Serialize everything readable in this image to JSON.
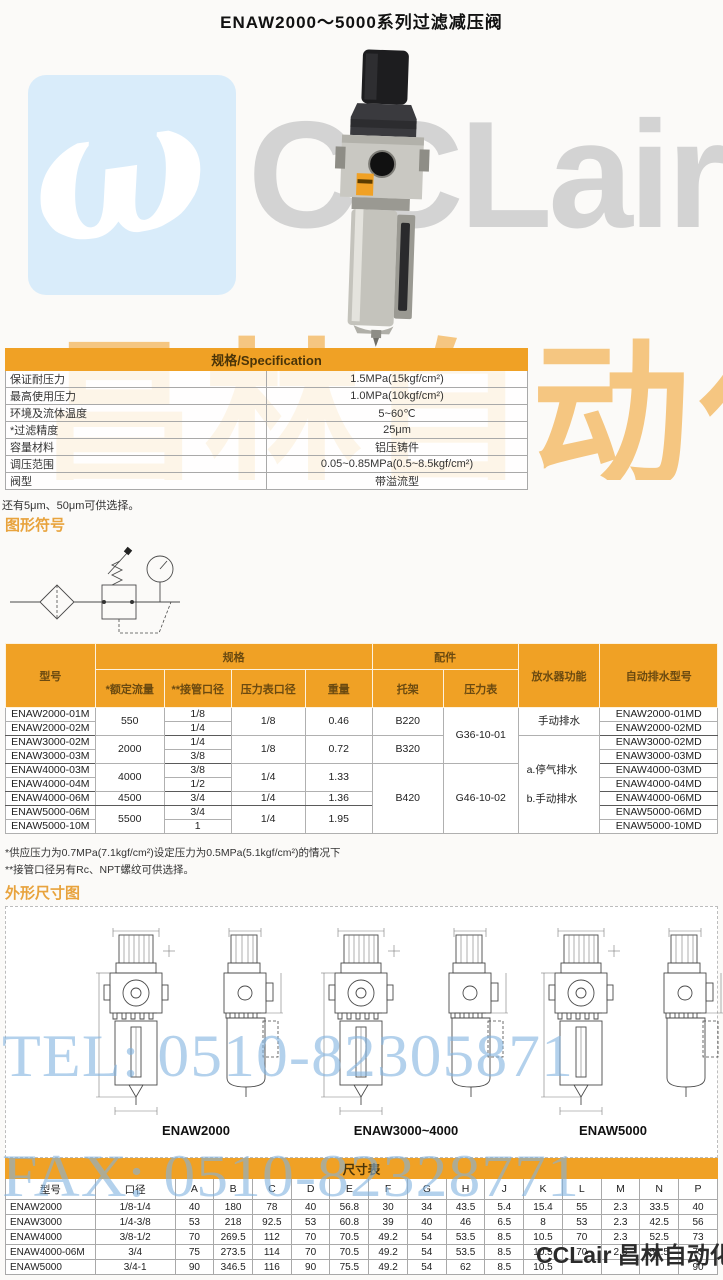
{
  "title": "ENAW2000～5000系列过滤减压阀",
  "watermark": {
    "logo_glyph": "ω",
    "brand": "CCLair",
    "brand_cn": "昌林自动化",
    "tel": "TEL: 0510-82305871",
    "fax": "FAX: 0510-82328771",
    "bottom_brand": "CCLair 昌林自动化",
    "accent_orange": "#f0a125",
    "accent_blue": "#d9ecfa"
  },
  "spec": {
    "header": "规格/Specification",
    "rows": [
      {
        "label": "保证耐压力",
        "value": "1.5MPa(15kgf/cm²)"
      },
      {
        "label": "最高使用压力",
        "value": "1.0MPa(10kgf/cm²)"
      },
      {
        "label": "环境及流体温度",
        "value": "5~60℃"
      },
      {
        "label": "*过滤精度",
        "value": "25μm"
      },
      {
        "label": "容量材料",
        "value": "铝压铸件"
      },
      {
        "label": "调压范围",
        "value": "0.05~0.85MPa(0.5~8.5kgf/cm²)"
      },
      {
        "label": "阀型",
        "value": "带溢流型"
      }
    ],
    "note": "还有5μm、50μm可供选择。"
  },
  "symbol": {
    "title": "图形符号"
  },
  "model_table": {
    "col_model": "型号",
    "group_spec": "规格",
    "group_acc": "配件",
    "col_flow": "*额定流量",
    "col_port": "**接管口径",
    "col_gauge_port": "压力表口径",
    "col_weight": "重量",
    "col_bracket": "托架",
    "col_gauge": "压力表",
    "col_drain": "放水器功能",
    "col_auto": "自动排水型号",
    "models": [
      "ENAW2000-01M",
      "ENAW2000-02M",
      "ENAW3000-02M",
      "ENAW3000-03M",
      "ENAW4000-03M",
      "ENAW4000-04M",
      "ENAW4000-06M",
      "ENAW5000-06M",
      "ENAW5000-10M"
    ],
    "ports": [
      "1/8",
      "1/4",
      "1/4",
      "3/8",
      "3/8",
      "1/2",
      "3/4",
      "3/4",
      "1"
    ],
    "flows": [
      "550",
      "2000",
      "4000",
      "4500",
      "5500"
    ],
    "gauge_ports": [
      "1/8",
      "1/8",
      "1/4",
      "1/4",
      "1/4"
    ],
    "weights": [
      "0.46",
      "0.72",
      "1.33",
      "1.36",
      "1.95"
    ],
    "brackets": [
      "B220",
      "B320",
      "B420"
    ],
    "gauges": [
      "G36-10-01",
      "G46-10-02"
    ],
    "drain_manual": "手动排水",
    "drain_a": "a.停气排水",
    "drain_b": "b.手动排水",
    "autos": [
      "ENAW2000-01MD",
      "ENAW2000-02MD",
      "ENAW3000-02MD",
      "ENAW3000-03MD",
      "ENAW4000-03MD",
      "ENAW4000-04MD",
      "ENAW4000-06MD",
      "ENAW5000-06MD",
      "ENAW5000-10MD"
    ],
    "note1": "*供应压力为0.7MPa(7.1kgf/cm²)设定压力为0.5MPa(5.1kgf/cm²)的情况下",
    "note2": "**接管口径另有Rc、NPT螺纹可供选择。"
  },
  "dimensions": {
    "title": "外形尺寸图",
    "labels": [
      "ENAW2000",
      "ENAW3000~4000",
      "ENAW5000"
    ]
  },
  "size_table": {
    "title": "尺寸表",
    "headers": [
      "型号",
      "口径",
      "A",
      "B",
      "C",
      "D",
      "E",
      "F",
      "G",
      "H",
      "J",
      "K",
      "L",
      "M",
      "N",
      "P"
    ],
    "rows": [
      [
        "ENAW2000",
        "1/8-1/4",
        "40",
        "180",
        "78",
        "40",
        "56.8",
        "30",
        "34",
        "43.5",
        "5.4",
        "15.4",
        "55",
        "2.3",
        "33.5",
        "40"
      ],
      [
        "ENAW3000",
        "1/4-3/8",
        "53",
        "218",
        "92.5",
        "53",
        "60.8",
        "39",
        "40",
        "46",
        "6.5",
        "8",
        "53",
        "2.3",
        "42.5",
        "56"
      ],
      [
        "ENAW4000",
        "3/8-1/2",
        "70",
        "269.5",
        "112",
        "70",
        "70.5",
        "49.2",
        "54",
        "53.5",
        "8.5",
        "10.5",
        "70",
        "2.3",
        "52.5",
        "73"
      ],
      [
        "ENAW4000-06M",
        "3/4",
        "75",
        "273.5",
        "114",
        "70",
        "70.5",
        "49.2",
        "54",
        "53.5",
        "8.5",
        "10.5",
        "70",
        "2.3",
        "52.5",
        "73"
      ],
      [
        "ENAW5000",
        "3/4-1",
        "90",
        "346.5",
        "116",
        "90",
        "75.5",
        "49.2",
        "54",
        "62",
        "8.5",
        "10.5",
        "",
        "",
        "",
        "90"
      ]
    ]
  }
}
